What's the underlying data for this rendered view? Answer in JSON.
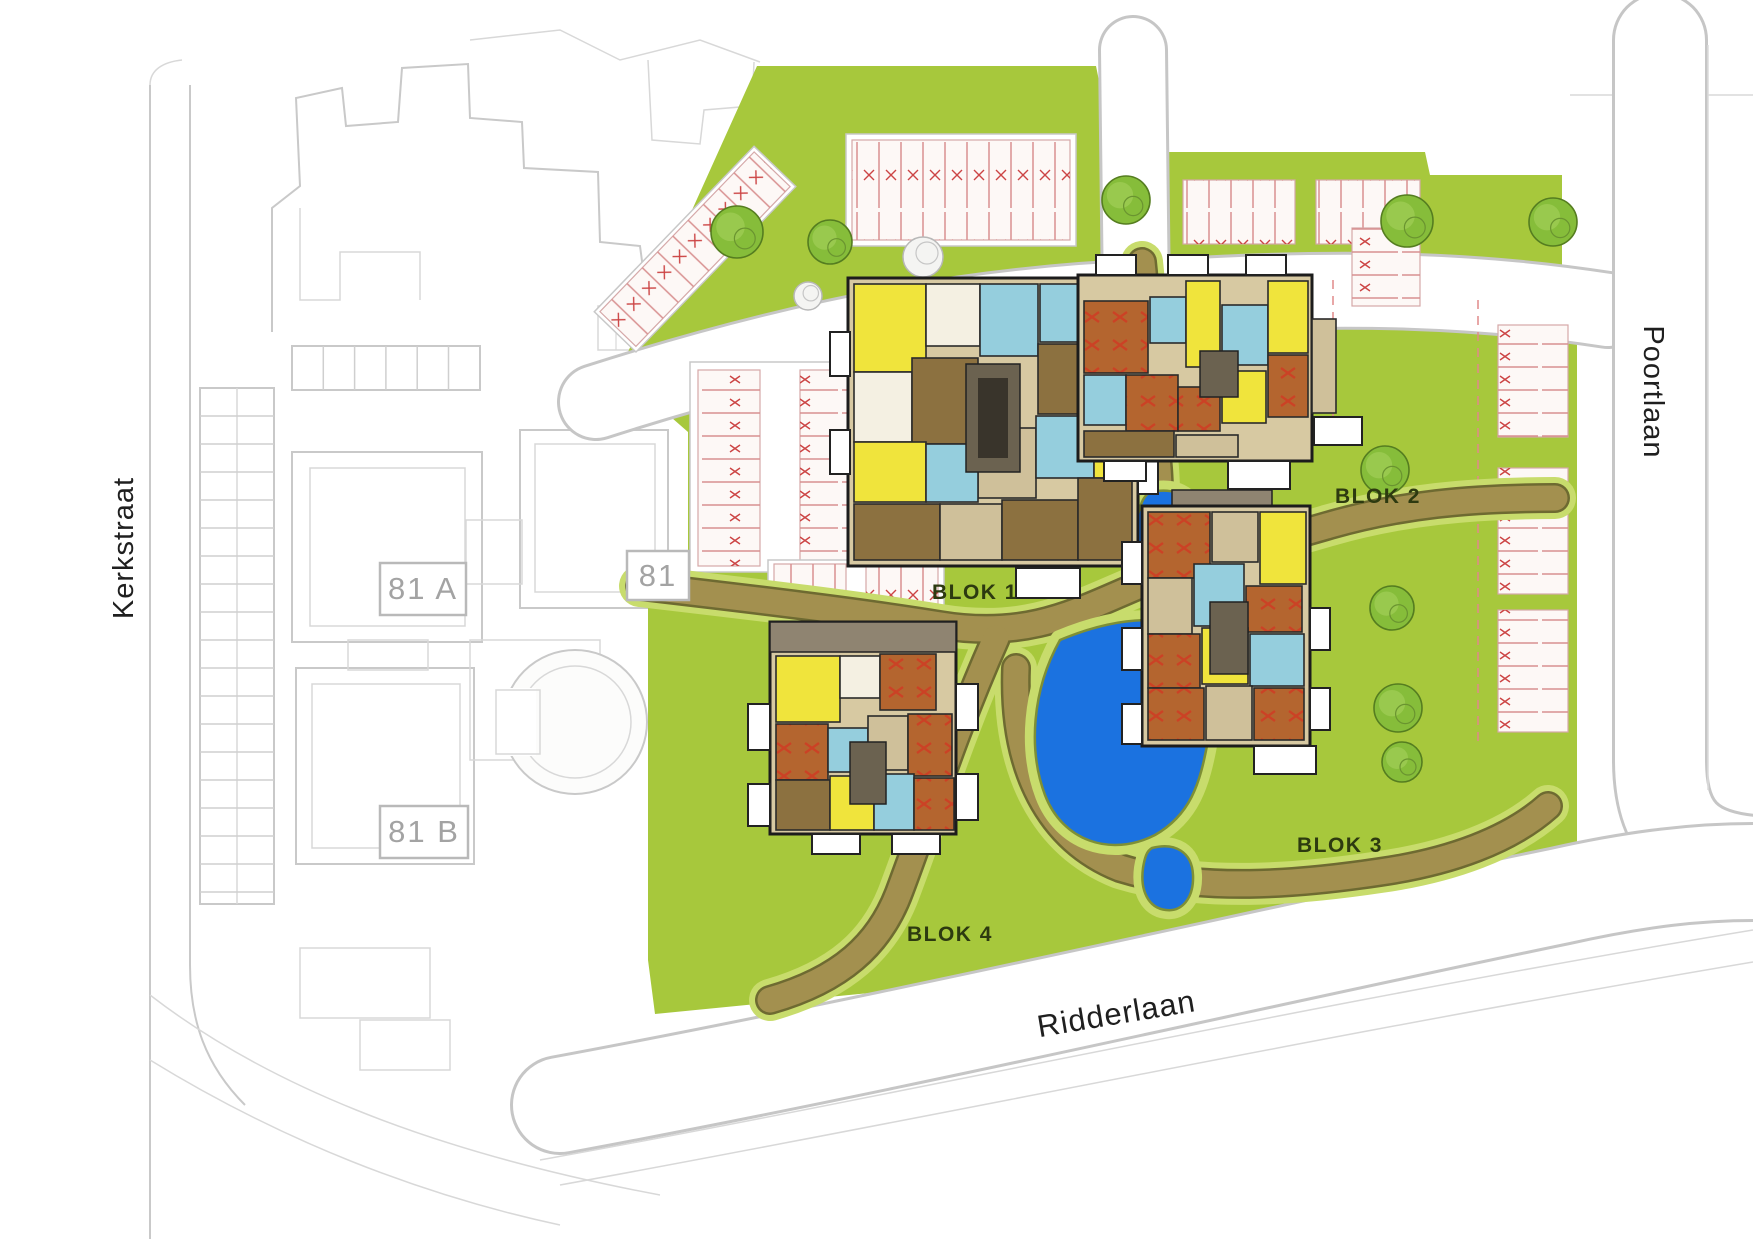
{
  "streets": {
    "left": "Kerkstraat",
    "right": "Poortlaan",
    "bottom": "Ridderlaan"
  },
  "existing_buildings": {
    "a": "81 A",
    "mid": "81",
    "b": "81 B"
  },
  "blocks": {
    "b1": "BLOK 1",
    "b2": "BLOK 2",
    "b3": "BLOK 3",
    "b4": "BLOK 4"
  },
  "legend_colors": {
    "lawn": "#a7c83c",
    "path": "#a3904f",
    "path_edge": "#6e6a31",
    "water": "#1b72e0",
    "room_yellow": "#f0e43c",
    "room_terracotta": "#b4652f",
    "room_cyan": "#95cedd",
    "room_tan": "#cfc09a",
    "room_brown": "#8c7140",
    "room_taupe": "#8f8471",
    "building_outline": "#1c1c1c",
    "parking_mark": "#cc4444",
    "sketch_line": "#c9c9c9",
    "existing_label_gray": "#a3a3a3",
    "block_label_green": "#2d3a10",
    "tree_green": "#86bd3a"
  }
}
